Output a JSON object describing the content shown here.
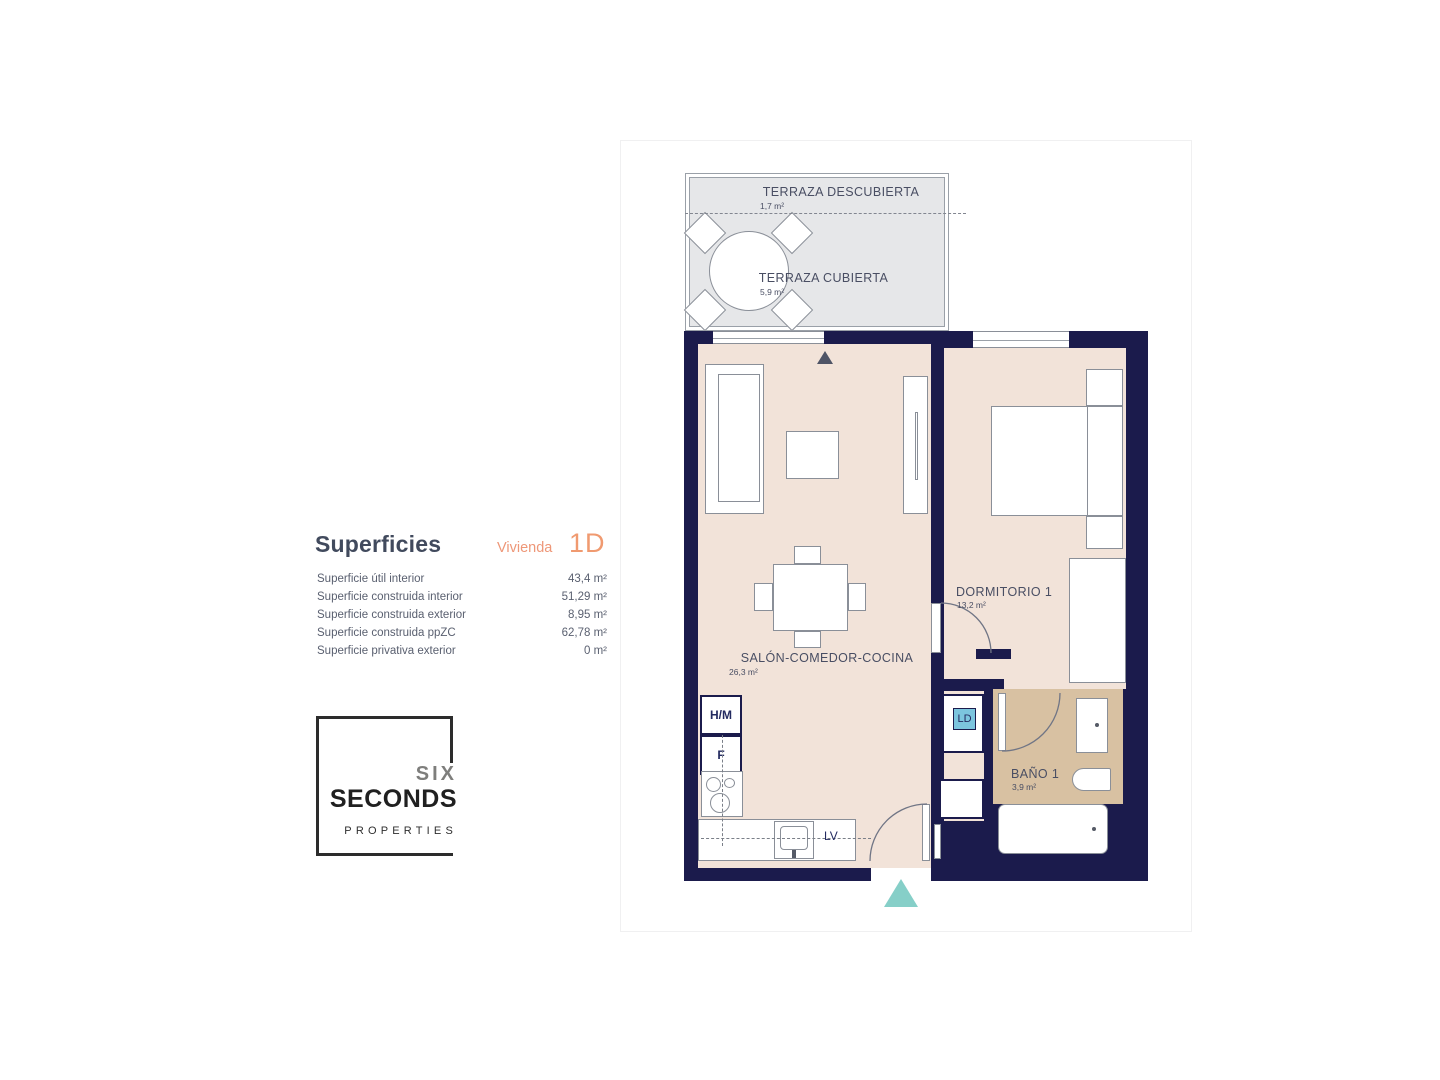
{
  "info_panel": {
    "title": "Superficies",
    "unit_label": "Vivienda",
    "unit_value": "1D",
    "rows": [
      {
        "label": "Superficie útil interior",
        "value": "43,4 m²"
      },
      {
        "label": "Superficie construida interior",
        "value": "51,29 m²"
      },
      {
        "label": "Superficie construida exterior",
        "value": "8,95 m²"
      },
      {
        "label": "Superficie construida ppZC",
        "value": "62,78 m²"
      },
      {
        "label": "Superficie privativa exterior",
        "value": "0 m²"
      }
    ]
  },
  "logo": {
    "top": "SIX",
    "middle": "SECONDS",
    "bottom": "PROPERTIES"
  },
  "floor_plan": {
    "terraces": [
      {
        "name": "TERRAZA DESCUBIERTA",
        "area": "1,7 m²"
      },
      {
        "name": "TERRAZA CUBIERTA",
        "area": "5,9 m²"
      }
    ],
    "rooms": [
      {
        "name": "SALÓN-COMEDOR-COCINA",
        "area": "26,3 m²"
      },
      {
        "name": "DORMITORIO 1",
        "area": "13,2 m²"
      },
      {
        "name": "BAÑO 1",
        "area": "3,9 m²"
      }
    ],
    "labels": {
      "hm": "H/M",
      "f": "F",
      "ld": "LD",
      "lv": "LV"
    }
  },
  "colors": {
    "wall": "#1b1b4c",
    "floor": "#f2e3d9",
    "bathroom_floor": "#d8c1a2",
    "terrace": "#e6e7e9",
    "accent_orange": "#ee9472",
    "entrance_marker": "#86cfc8",
    "ld_highlight": "#7cc5de"
  }
}
